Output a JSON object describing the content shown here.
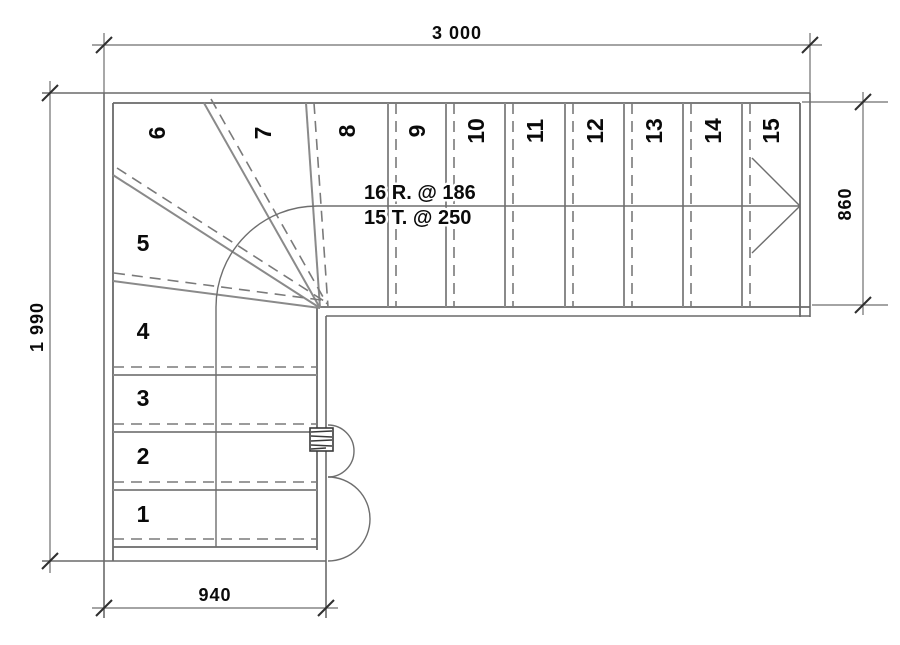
{
  "drawing": {
    "type": "staircase floor plan",
    "annotation": {
      "risers": "16 R. @ 186",
      "treads": "15 T. @ 250"
    },
    "dimensions": {
      "top": "3 000",
      "left": "1 990",
      "right": "860",
      "bottom": "940"
    },
    "step_labels": [
      "1",
      "2",
      "3",
      "4",
      "5",
      "6",
      "7",
      "8",
      "9",
      "10",
      "11",
      "12",
      "13",
      "14",
      "15"
    ]
  },
  "colors": {
    "background": "#ffffff",
    "line": "#6a6a6a",
    "riser_line": "#8a8a8a",
    "text": "#0a0a0a"
  }
}
